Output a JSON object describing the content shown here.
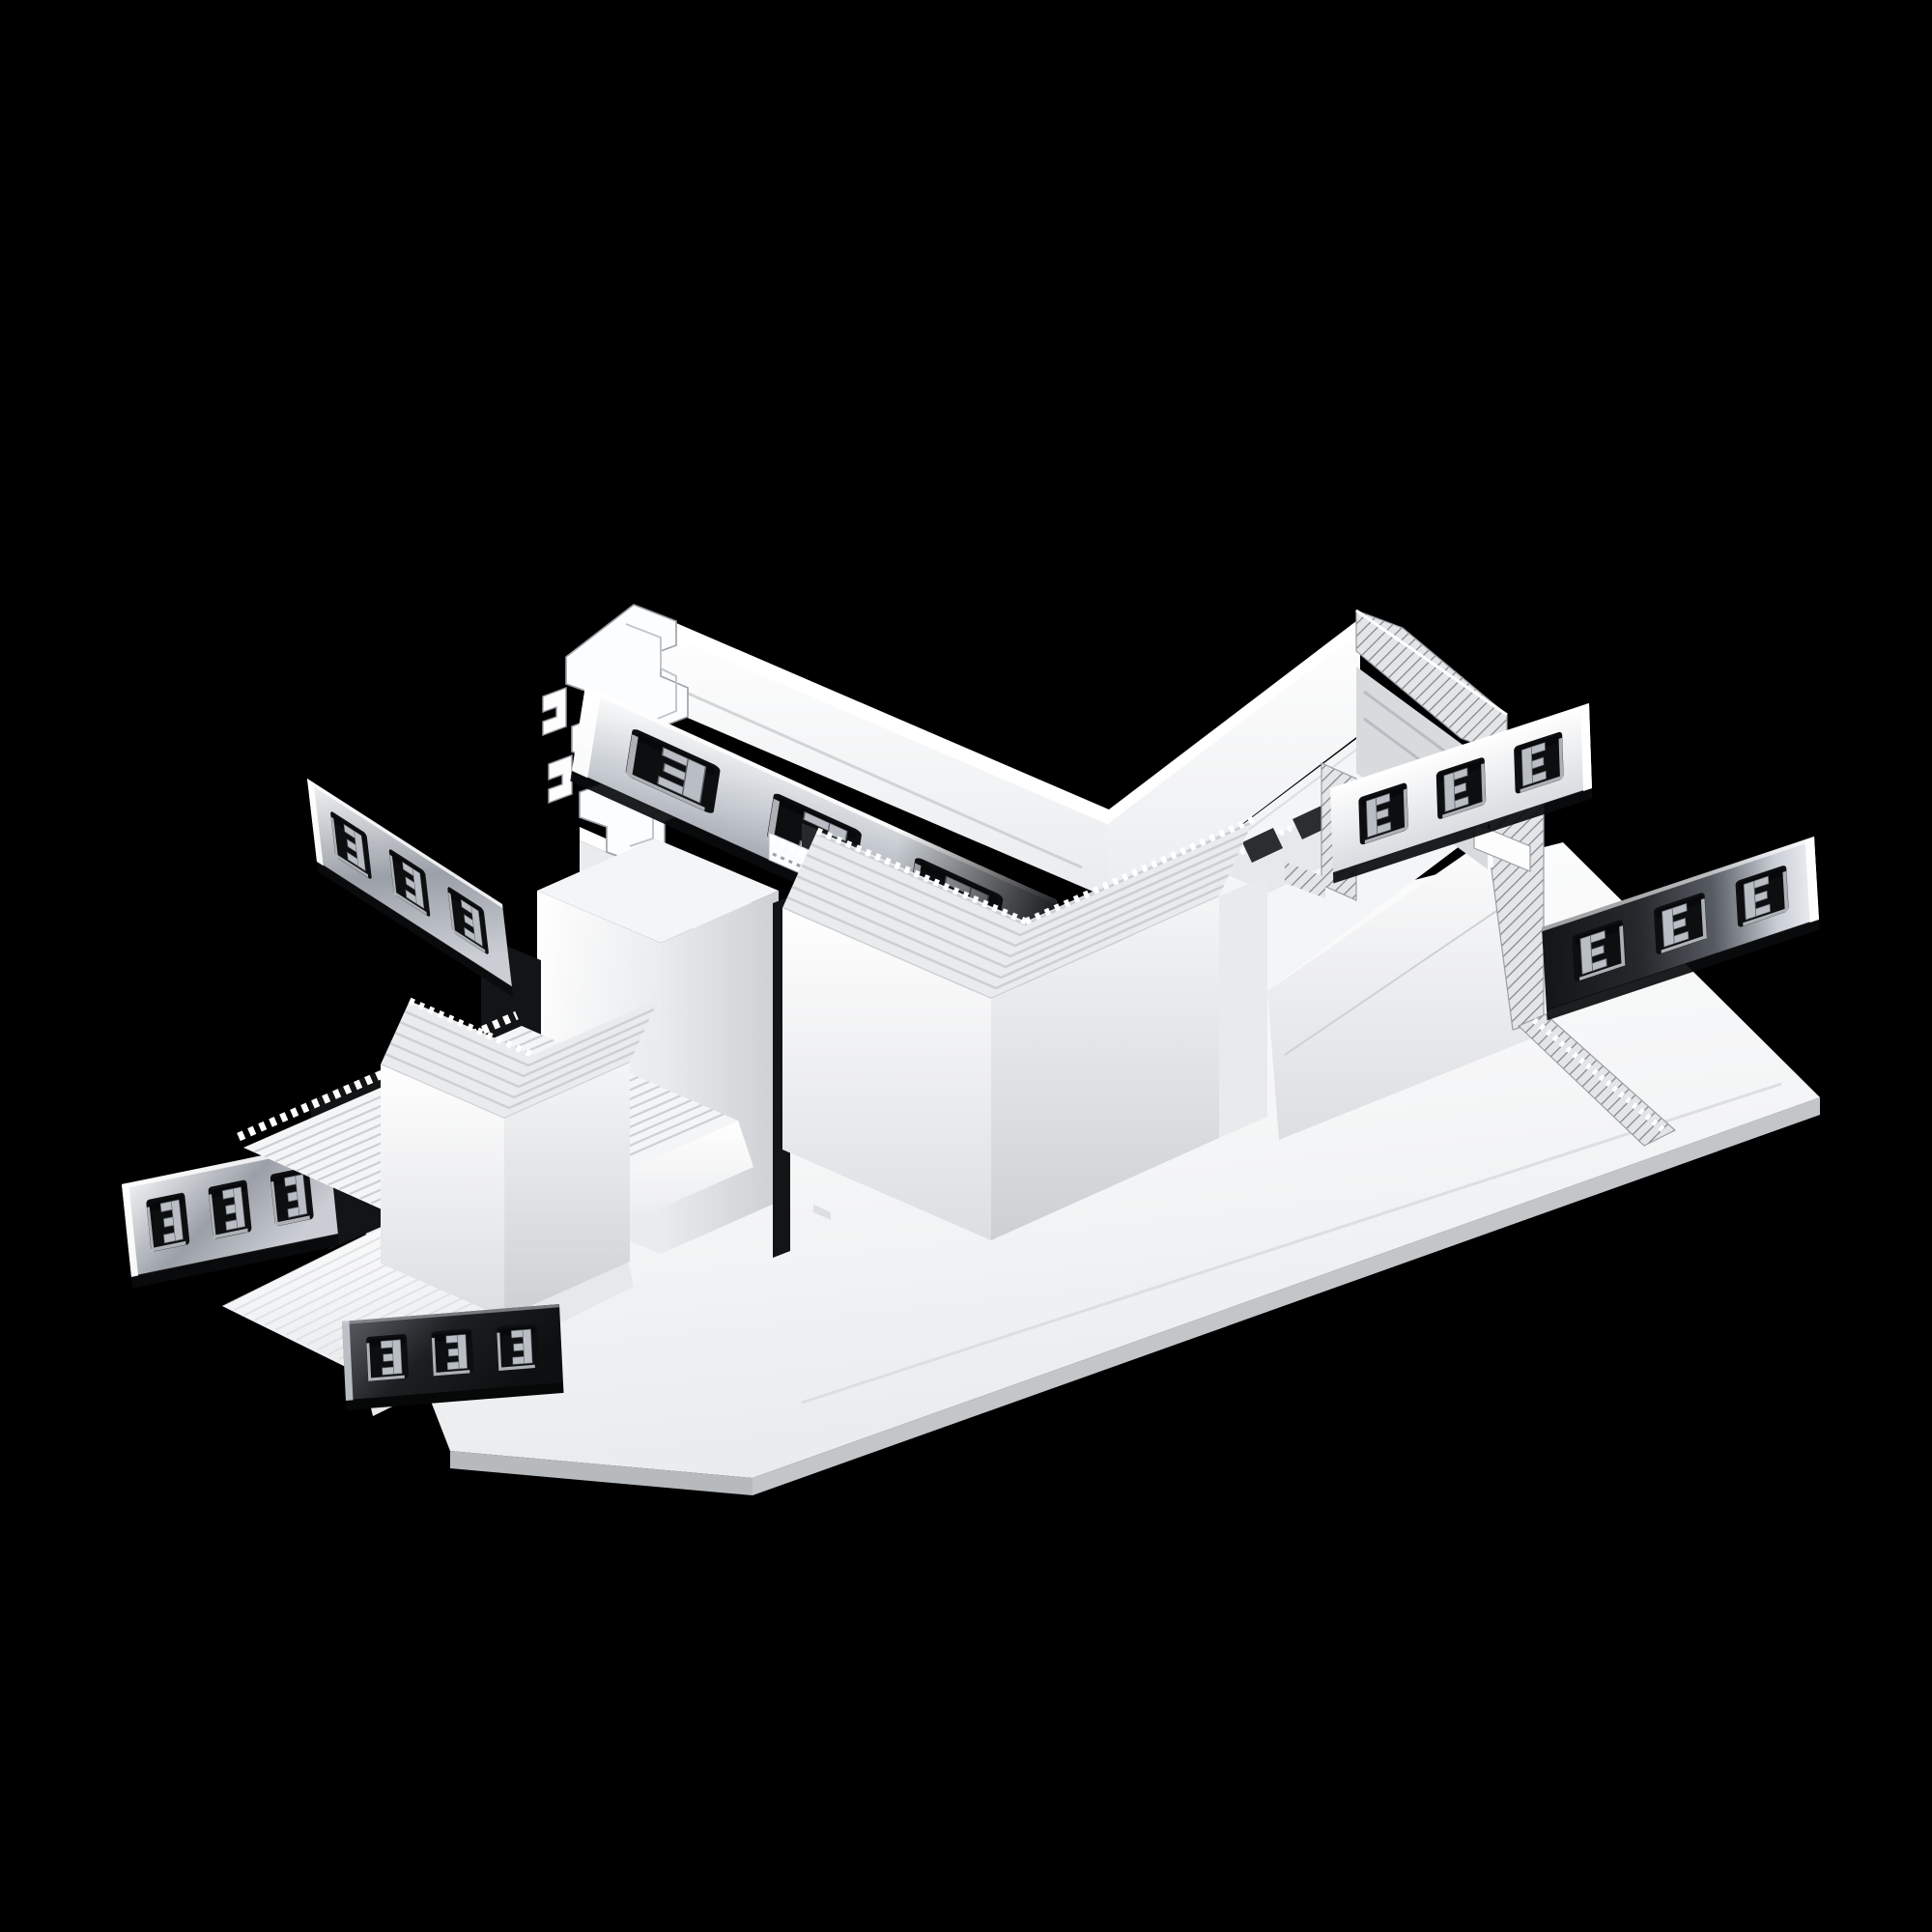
{
  "meta": {
    "type": "3d-product-render",
    "description": "Isometric 3D render on a black background: white recessed magnetic track lighting T-shaped connector with plaster-in trim flanges, ribbed corner covers, section-cut profile faces (one white, one hatched) and six perforated steel mounting straps, each with three E-shaped punched cutouts."
  },
  "palette": {
    "bg": "#000000",
    "white": "#ffffff",
    "body1": "#f4f5f6",
    "body2": "#e9ebed",
    "body3": "#dcdee1",
    "body4": "#cdd0d3",
    "shade": "#b9bcc0",
    "line": "#9aa0a5",
    "hatchline": "#7f848a",
    "hatchbg": "#e3e5e7",
    "slot": "#131416",
    "metalbright": "#f4f6f8",
    "metalmid": "#9ba0a8",
    "metaldark": "#3a3d42",
    "metalblack": "#141518",
    "chromehi": "#eef1f5"
  },
  "product": {
    "shape": "T-connector",
    "body_finish": "matte white aluminium",
    "strap_finish": "polished steel",
    "visible_arm_ends": [
      "white section-cut face (top left)",
      "hatched section-cut face (top right)",
      "ribbed covered end (bottom left)"
    ],
    "mounting_straps": {
      "count": 6,
      "cutouts_per_strap": 3,
      "cutout_shape": "E"
    },
    "ribbed_corner_covers": 2,
    "flange": "wide plaster-in flange plate"
  }
}
